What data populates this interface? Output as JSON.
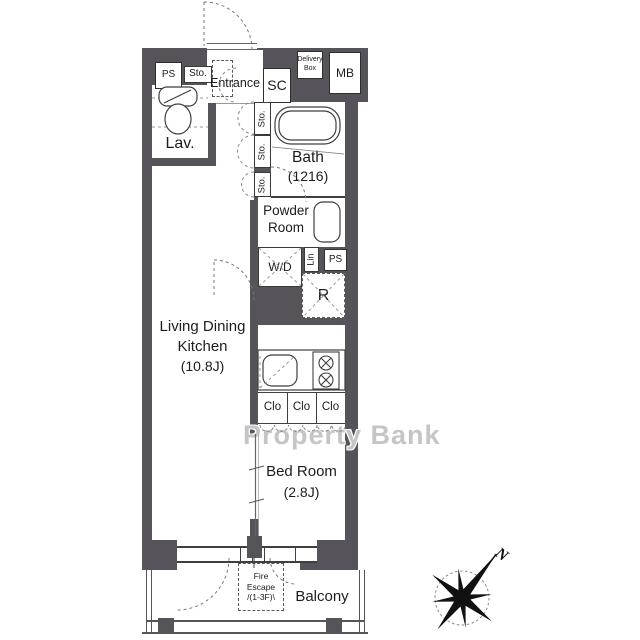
{
  "watermark": {
    "text": "Property Bank"
  },
  "compass": {
    "north": "N"
  },
  "rooms": {
    "entrance": {
      "name": "Entrance"
    },
    "lavatory": {
      "name": "Lav."
    },
    "bath": {
      "name": "Bath",
      "size": "(1216)"
    },
    "powder": {
      "line1": "Powder",
      "line2": "Room"
    },
    "ldk": {
      "name_line1": "Living Dining",
      "name_line2": "Kitchen",
      "size": "(10.8J)"
    },
    "bedroom": {
      "name": "Bed Room",
      "size": "(2.8J)"
    },
    "balcony": {
      "name": "Balcony"
    }
  },
  "fixtures": {
    "pipe_space_top": "PS",
    "pipe_space_mid": "PS",
    "storage_entrance": "Sto.",
    "storage_1": "Sto.",
    "storage_2": "Sto.",
    "storage_3": "Sto.",
    "shoe_closet": "SC",
    "delivery_line1": "Delivery",
    "delivery_line2": "Box",
    "mailbox": "MB",
    "washer_dryer": "W/D",
    "linen": "Lin",
    "refrigerator": "R",
    "closet_1": "Clo",
    "closet_2": "Clo",
    "closet_3": "Clo",
    "fire_escape_line1": "Fire",
    "fire_escape_line2": "Escape",
    "fire_escape_line3": "/(1-3F)\\"
  },
  "colors": {
    "wall": "#56535a",
    "line": "#3f3f3f",
    "floor": "#ffffff",
    "text": "#1c1c1c",
    "watermark": "#a0a0a0"
  }
}
